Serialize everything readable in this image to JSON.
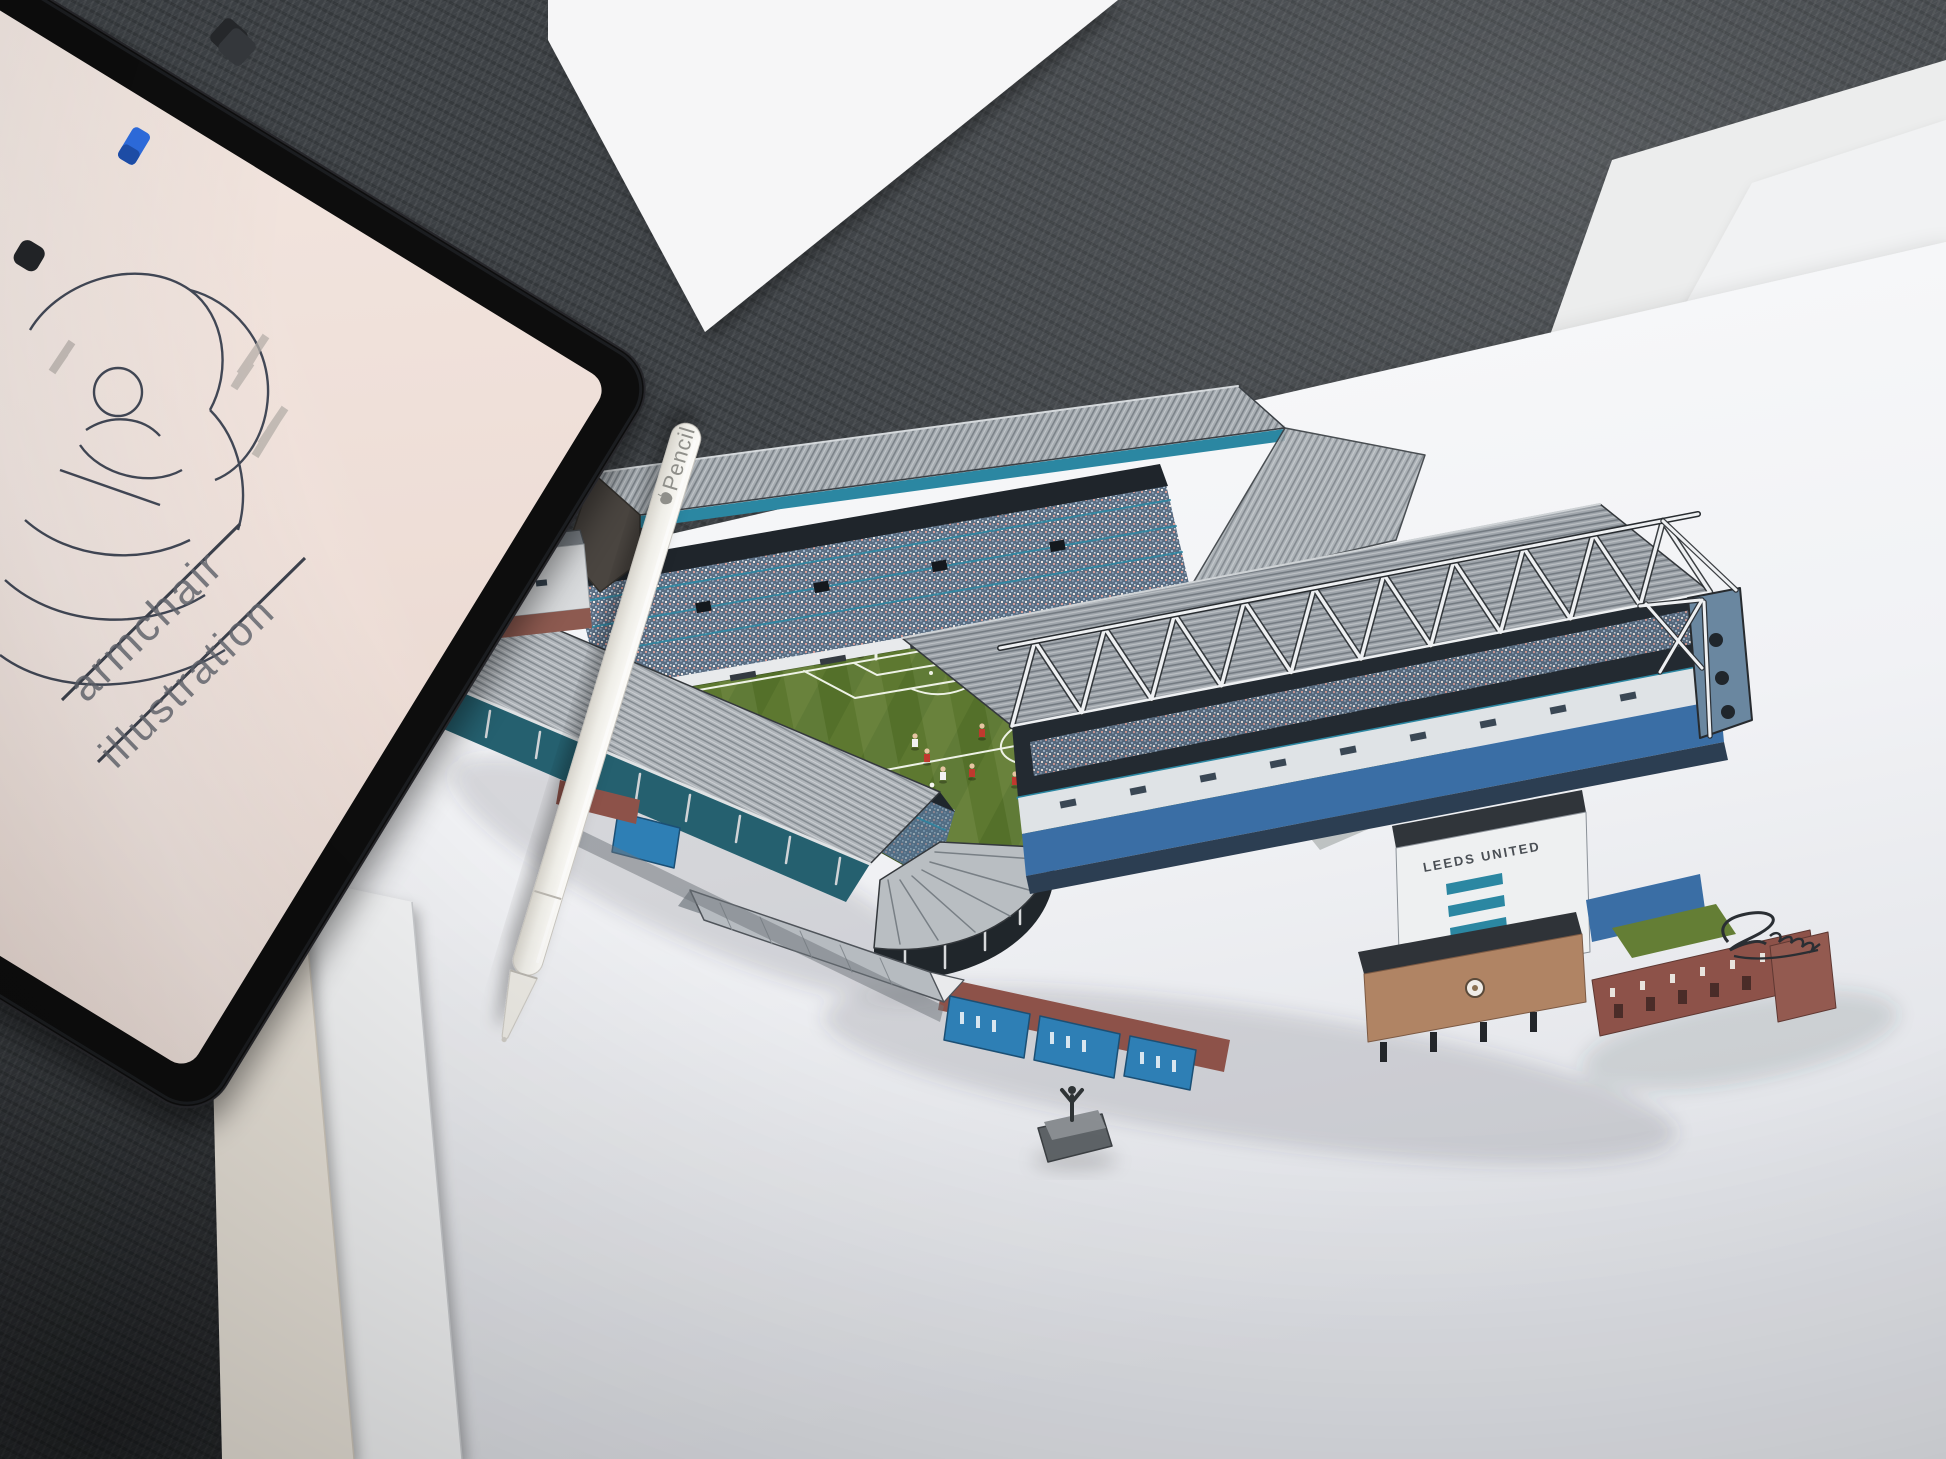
{
  "scene": {
    "description": "Photo of a desk: iPad with sketch app, Apple Pencil and a hand-drawn Elland Road stadium print on white sheets over dark slate",
    "surface": "dark slate"
  },
  "ipad_screen": {
    "watermark_line1": "armchair",
    "watermark_line2": "illustration"
  },
  "apple_pencil": {
    "label": "Pencil"
  },
  "stadium_print": {
    "east_stand_sign": "LEEDS UNITED"
  },
  "palette": {
    "slate": "#3e4246",
    "paper_white": "#f4f5f7",
    "paper_cream": "#eae4da",
    "ipad_black": "#0b0c0e",
    "screen_pink": "#f0e3dc",
    "teal_steel": "#2b87a2",
    "pitch_green": "#5a7430",
    "seat_blue": "#3a6ea5",
    "brick_red": "#8d5249",
    "annex_brown": "#b08464",
    "truss_white": "#eef0f2",
    "signature_ink": "#2a2e33"
  }
}
